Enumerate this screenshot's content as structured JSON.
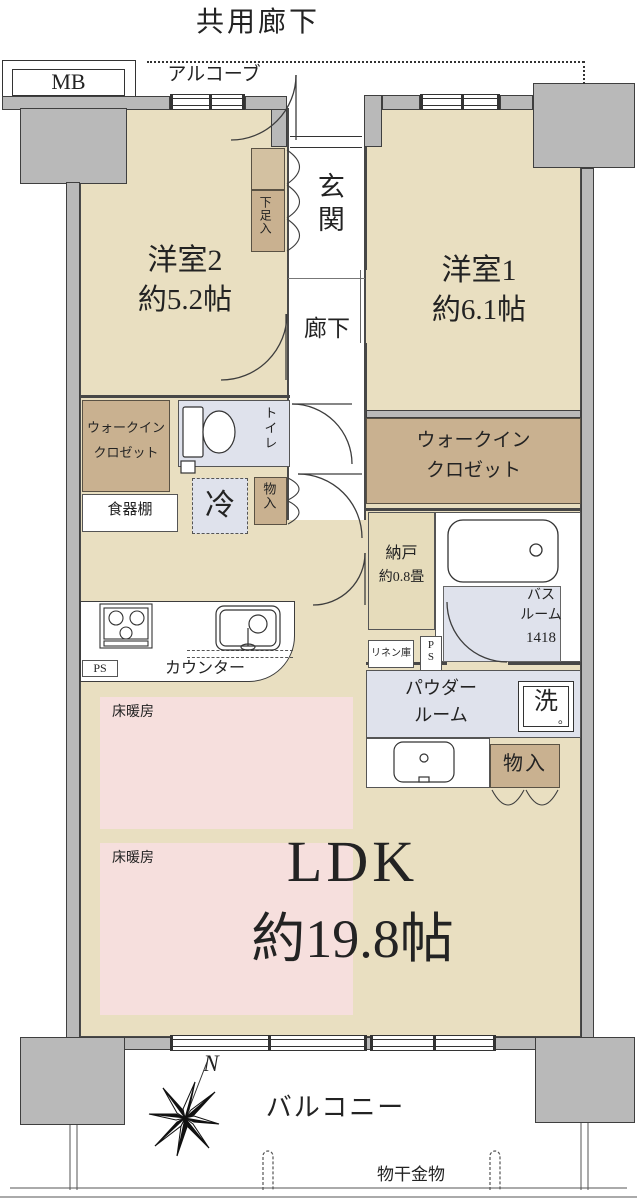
{
  "plan": {
    "header": {
      "common_corridor": "共用廊下",
      "mb": "MB",
      "alcove": "アルコーブ"
    },
    "rooms": {
      "room2": {
        "name": "洋室2",
        "size": "約5.2帖"
      },
      "room1": {
        "name": "洋室1",
        "size": "約6.1帖"
      },
      "genkan": "玄関",
      "hallway": "廊下",
      "shoe_closet": "下足入",
      "wic1": {
        "l1": "ウォークイン",
        "l2": "クロゼット"
      },
      "wic2": {
        "l1": "ウォークイン",
        "l2": "クロゼット"
      },
      "toilet": "トイレ",
      "cupboard": "食器棚",
      "fridge": "冷",
      "storage1": "物入",
      "storage2": "物入",
      "nando": {
        "name": "納戸",
        "size": "約0.8畳"
      },
      "bath": {
        "l1": "バス",
        "l2": "ルーム",
        "size": "1418"
      },
      "linen": "リネン庫",
      "ps1": "PS",
      "ps2": "PS",
      "powder": {
        "l1": "パウダー",
        "l2": "ルーム"
      },
      "laundry": "洗",
      "laundry_dot": "。",
      "counter": "カウンター",
      "heating1": "床暖房",
      "heating2": "床暖房",
      "ldk": {
        "name": "LDK",
        "size": "約19.8帖"
      }
    },
    "balcony": {
      "label": "バルコニー",
      "drying": "物干金物",
      "north": "N"
    },
    "colors": {
      "room_beige": "#e9dfc1",
      "closet_tan": "#c9b190",
      "wet_blue": "#dfe2ec",
      "heating_pink": "#f6dfdd",
      "wall_gray": "#b9b9b9",
      "nando_beige": "#e6dcbb"
    }
  }
}
